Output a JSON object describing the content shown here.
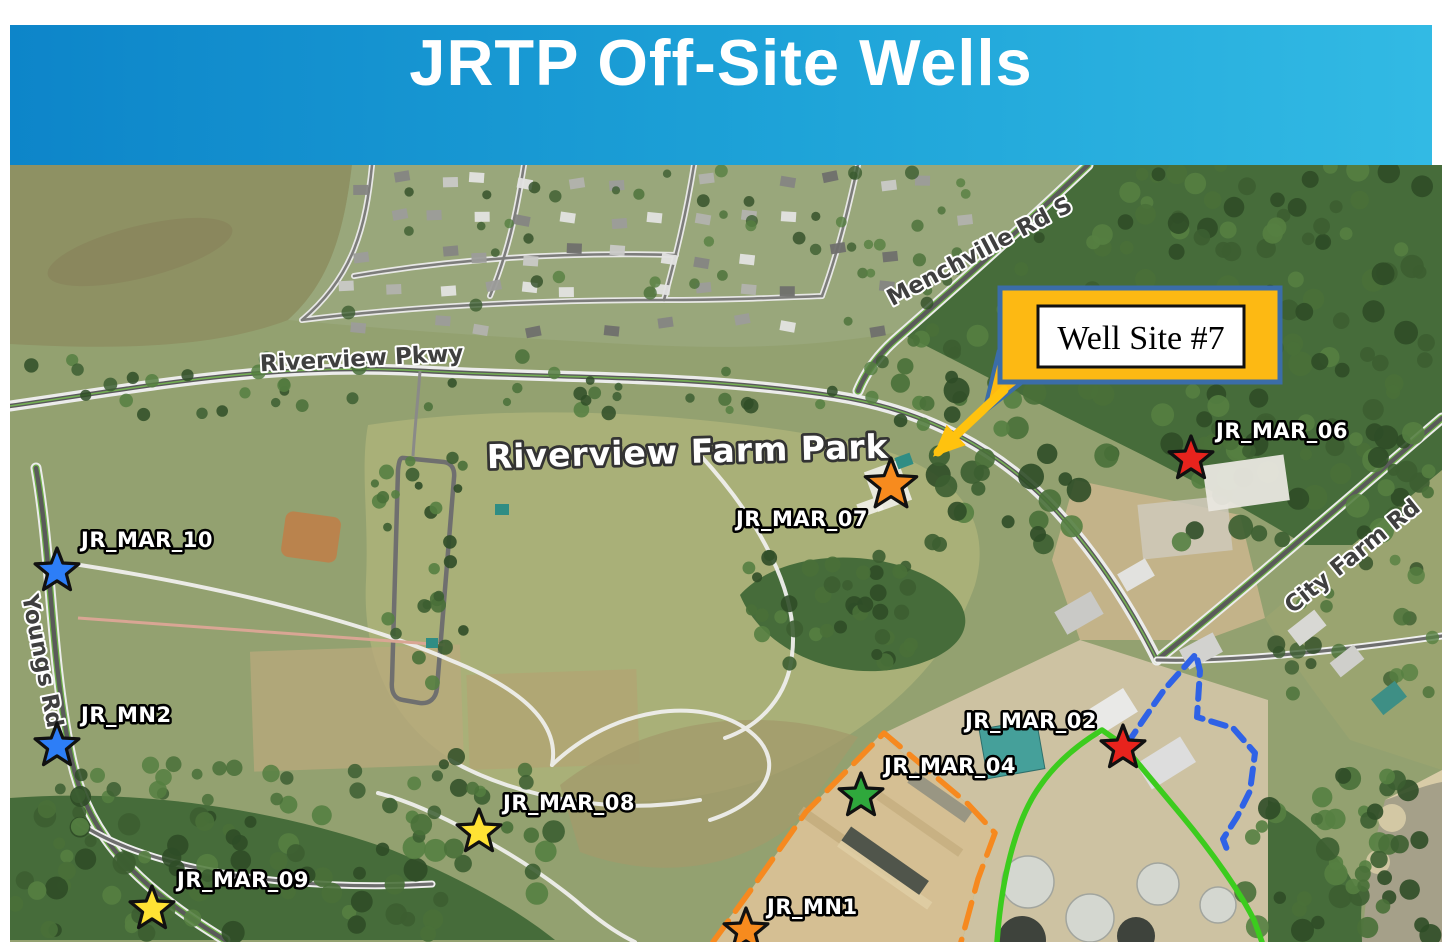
{
  "banner": {
    "title": "JRTP Off-Site Wells",
    "gradient_left": "#0d85c9",
    "gradient_right": "#32bae4",
    "text_color": "#ffffff"
  },
  "map": {
    "park_label": "Riverview Farm Park",
    "road_labels": [
      {
        "name": "Riverview Pkwy"
      },
      {
        "name": "Menchville Rd S"
      },
      {
        "name": "City Farm Rd"
      },
      {
        "name": "Youngs Rd"
      }
    ],
    "callout": {
      "label": "Well Site #7",
      "box_fill": "#fdb913",
      "box_border": "#3b6da8",
      "arrow_color": "#ffc20e"
    },
    "wells": [
      {
        "id": "JR_MAR_10",
        "color": "#2d7ef7",
        "x": 57,
        "y": 571,
        "lx": 81,
        "ly": 547,
        "anchor": "start"
      },
      {
        "id": "JR_MN2",
        "color": "#2d7ef7",
        "x": 57,
        "y": 746,
        "lx": 81,
        "ly": 722,
        "anchor": "start"
      },
      {
        "id": "JR_MAR_09",
        "color": "#ffe234",
        "x": 152,
        "y": 909,
        "lx": 177,
        "ly": 887,
        "anchor": "start"
      },
      {
        "id": "JR_MAR_08",
        "color": "#ffe234",
        "x": 479,
        "y": 832,
        "lx": 503,
        "ly": 810,
        "anchor": "start"
      },
      {
        "id": "JR_MAR_07",
        "color": "#f78b1e",
        "x": 891,
        "y": 485,
        "lx": 868,
        "ly": 526,
        "anchor": "end"
      },
      {
        "id": "JR_MAR_06",
        "color": "#e8231d",
        "x": 1191,
        "y": 459,
        "lx": 1216,
        "ly": 438,
        "anchor": "start"
      },
      {
        "id": "JR_MAR_02",
        "color": "#e8231d",
        "x": 1123,
        "y": 748,
        "lx": 1097,
        "ly": 728,
        "anchor": "end"
      },
      {
        "id": "JR_MAR_04",
        "color": "#2fa83c",
        "x": 861,
        "y": 796,
        "lx": 884,
        "ly": 773,
        "anchor": "start"
      },
      {
        "id": "JR_MN1",
        "color": "#f78b1e",
        "x": 746,
        "y": 931,
        "lx": 767,
        "ly": 914,
        "anchor": "start"
      }
    ],
    "boundaries": [
      {
        "name": "site-boundary-orange-dashed",
        "color": "#f6891f",
        "style": "dashed"
      },
      {
        "name": "plant-boundary-green-solid",
        "color": "#3ccc1e",
        "style": "solid"
      },
      {
        "name": "parcel-boundary-blue-dashed",
        "color": "#2f62e6",
        "style": "dashed"
      }
    ]
  }
}
